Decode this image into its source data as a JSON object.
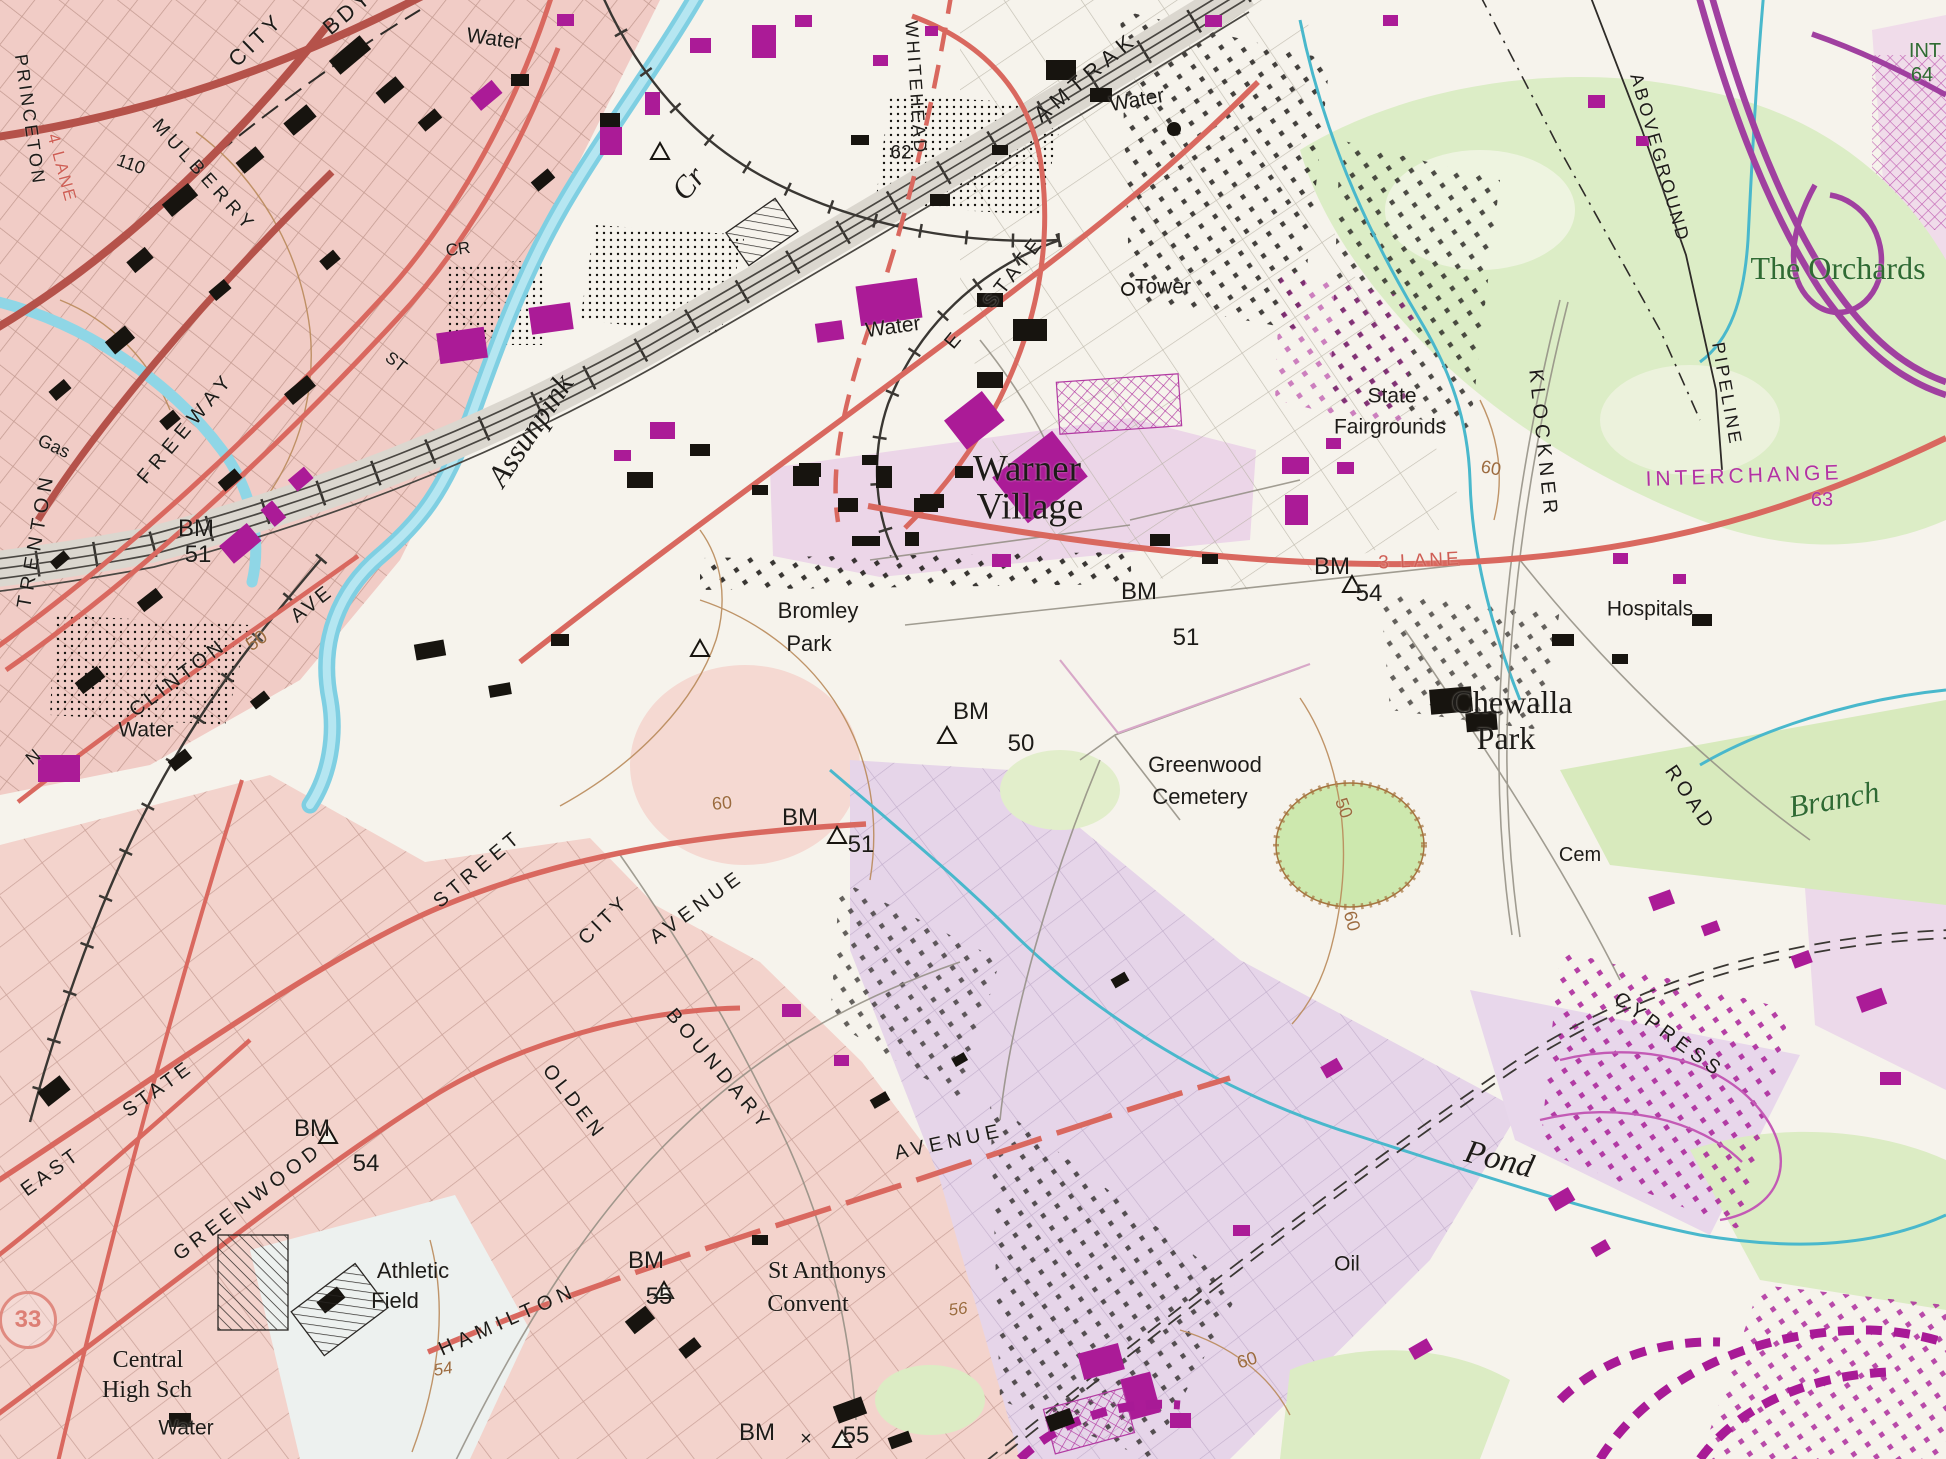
{
  "map": {
    "type": "scanned-topographic-map",
    "shield": {
      "text": "33"
    },
    "colors": {
      "paper": "#f6f3ec",
      "urban_pink": "#f1cdc7",
      "residential_lavender": "#e9d6ea",
      "park_green": "#d9ecc1",
      "water_cyan": "#a6dfee",
      "stream_teal": "#49b8cc",
      "road_red": "#d9685f",
      "building_magenta": "#ab1b97",
      "contour_brown": "#9c6b3f",
      "label_green": "#2f6b33",
      "highway_purple": "#a040a0",
      "ink_black": "#1d1b18"
    },
    "labels": [
      {
        "n": "water-top",
        "t": "Water",
        "x": 494,
        "y": 39,
        "r": 8,
        "s": 21
      },
      {
        "n": "city-bdy-1",
        "t": "CITY",
        "x": 256,
        "y": 40,
        "r": -44,
        "s": 22,
        "ls": 4
      },
      {
        "n": "city-bdy-2",
        "t": "BDY",
        "x": 348,
        "y": 12,
        "r": -40,
        "s": 22,
        "ls": 4
      },
      {
        "n": "princeton",
        "t": "PRINCETON",
        "x": 30,
        "y": 120,
        "r": 82,
        "s": 18,
        "ls": 3
      },
      {
        "n": "four-lane",
        "t": "4 LANE",
        "x": 62,
        "y": 168,
        "r": 75,
        "s": 17,
        "ls": 2,
        "c": "r"
      },
      {
        "n": "contour-110",
        "t": "110",
        "x": 131,
        "y": 164,
        "r": 20,
        "s": 18
      },
      {
        "n": "mulberry",
        "t": "MULBERRY",
        "x": 204,
        "y": 176,
        "r": 48,
        "s": 19,
        "ls": 5
      },
      {
        "n": "cr-abbrev",
        "t": "CR",
        "x": 458,
        "y": 249,
        "r": -8,
        "s": 17
      },
      {
        "n": "st-abbrev",
        "t": "ST",
        "x": 396,
        "y": 362,
        "r": 38,
        "s": 17
      },
      {
        "n": "assunpink",
        "t": "Assunpink",
        "x": 530,
        "y": 430,
        "r": -56,
        "s": 31,
        "f": "serif",
        "i": 1
      },
      {
        "n": "assunpink-cr",
        "t": "Cr",
        "x": 688,
        "y": 183,
        "r": -50,
        "s": 31,
        "f": "serif",
        "i": 1
      },
      {
        "n": "trenton",
        "t": "TRENTON",
        "x": 36,
        "y": 540,
        "r": -80,
        "s": 20,
        "ls": 6
      },
      {
        "n": "freeway",
        "t": "FREEWAY",
        "x": 186,
        "y": 428,
        "r": -50,
        "s": 20,
        "ls": 6
      },
      {
        "n": "gas",
        "t": "Gas",
        "x": 54,
        "y": 446,
        "r": 25,
        "s": 18
      },
      {
        "n": "bm-left",
        "t": "BM",
        "x": 196,
        "y": 529,
        "s": 24
      },
      {
        "n": "bm-left-51",
        "t": "51",
        "x": 198,
        "y": 555,
        "s": 24
      },
      {
        "n": "clinton",
        "t": "CLINTON",
        "x": 178,
        "y": 678,
        "r": -37,
        "s": 20,
        "ls": 4
      },
      {
        "n": "contour-50-clinton",
        "t": "50",
        "x": 257,
        "y": 641,
        "r": -35,
        "s": 19,
        "c": "b"
      },
      {
        "n": "clinton-ave",
        "t": "AVE",
        "x": 312,
        "y": 604,
        "r": -38,
        "s": 20,
        "ls": 3
      },
      {
        "n": "water-left",
        "t": "Water",
        "x": 146,
        "y": 730,
        "s": 21
      },
      {
        "n": "n-clinton",
        "t": "N",
        "x": 33,
        "y": 757,
        "r": -40,
        "s": 18
      },
      {
        "n": "whitehead",
        "t": "WHITEHEAD",
        "x": 916,
        "y": 88,
        "r": 86,
        "s": 18,
        "ls": 3
      },
      {
        "n": "amtrak",
        "t": "AMTRAK",
        "x": 1086,
        "y": 77,
        "r": -40,
        "s": 22,
        "ls": 6
      },
      {
        "n": "water-amtrak",
        "t": "Water",
        "x": 1137,
        "y": 100,
        "r": -10,
        "s": 21
      },
      {
        "n": "contour-62",
        "t": "62",
        "x": 901,
        "y": 153,
        "s": 19
      },
      {
        "n": "e-state-e",
        "t": "E",
        "x": 953,
        "y": 341,
        "r": -50,
        "s": 20
      },
      {
        "n": "e-state",
        "t": "STATE",
        "x": 1014,
        "y": 272,
        "r": -52,
        "s": 20,
        "ls": 5
      },
      {
        "n": "tower",
        "t": "Tower",
        "x": 1163,
        "y": 287,
        "s": 21
      },
      {
        "n": "state-fairgrounds-1",
        "t": "State",
        "x": 1392,
        "y": 396,
        "s": 21
      },
      {
        "n": "state-fairgrounds-2",
        "t": "Fairgrounds",
        "x": 1390,
        "y": 427,
        "s": 21
      },
      {
        "n": "warner-village-1",
        "t": "Warner",
        "x": 1027,
        "y": 469,
        "s": 37,
        "f": "serif"
      },
      {
        "n": "warner-village-2",
        "t": "Village",
        "x": 1030,
        "y": 507,
        "s": 37,
        "f": "serif"
      },
      {
        "n": "bromley-park-1",
        "t": "Bromley",
        "x": 818,
        "y": 611,
        "s": 22
      },
      {
        "n": "bromley-park-2",
        "t": "Park",
        "x": 809,
        "y": 644,
        "s": 22
      },
      {
        "n": "bm-warner",
        "t": "BM",
        "x": 1139,
        "y": 592,
        "s": 24
      },
      {
        "n": "bm-warner-51",
        "t": "51",
        "x": 1186,
        "y": 638,
        "s": 24
      },
      {
        "n": "bm-54",
        "t": "BM",
        "x": 1332,
        "y": 567,
        "s": 24
      },
      {
        "n": "bm-54-num",
        "t": "54",
        "x": 1369,
        "y": 594,
        "s": 24
      },
      {
        "n": "three-lane",
        "t": "3 LANE",
        "x": 1420,
        "y": 561,
        "r": -3,
        "s": 19,
        "ls": 3,
        "c": "r"
      },
      {
        "n": "klockner",
        "t": "KLOCKNER",
        "x": 1543,
        "y": 444,
        "r": 84,
        "s": 20,
        "ls": 5
      },
      {
        "n": "aboveground",
        "t": "ABOVEGROUND",
        "x": 1660,
        "y": 158,
        "r": 74,
        "s": 18,
        "ls": 3
      },
      {
        "n": "pipeline",
        "t": "PIPELINE",
        "x": 1727,
        "y": 394,
        "r": 80,
        "s": 18,
        "ls": 3
      },
      {
        "n": "interchange",
        "t": "INTERCHANGE",
        "x": 1744,
        "y": 476,
        "r": -2,
        "s": 21,
        "ls": 4,
        "c": "m"
      },
      {
        "n": "interchange-63",
        "t": "63",
        "x": 1822,
        "y": 500,
        "s": 20,
        "c": "m"
      },
      {
        "n": "contour-60-klockner",
        "t": "60",
        "x": 1491,
        "y": 468,
        "r": 10,
        "s": 18,
        "c": "b"
      },
      {
        "n": "the-orchards",
        "t": "The Orchards",
        "x": 1838,
        "y": 268,
        "s": 32,
        "f": "serif",
        "c": "g"
      },
      {
        "n": "int-64-1",
        "t": "INT",
        "x": 1925,
        "y": 51,
        "s": 20,
        "c": "g"
      },
      {
        "n": "int-64-2",
        "t": "64",
        "x": 1922,
        "y": 75,
        "s": 20,
        "c": "g"
      },
      {
        "n": "hospitals",
        "t": "Hospitals",
        "x": 1650,
        "y": 609,
        "s": 21
      },
      {
        "n": "chewalla-park-1",
        "t": "Chewalla",
        "x": 1512,
        "y": 702,
        "s": 32,
        "f": "serif"
      },
      {
        "n": "chewalla-park-2",
        "t": "Park",
        "x": 1506,
        "y": 738,
        "s": 32,
        "f": "serif"
      },
      {
        "n": "road",
        "t": "ROAD",
        "x": 1690,
        "y": 798,
        "r": 56,
        "s": 20,
        "ls": 4
      },
      {
        "n": "branch",
        "t": "Branch",
        "x": 1834,
        "y": 799,
        "r": -10,
        "s": 31,
        "f": "serif",
        "i": 1,
        "c": "g"
      },
      {
        "n": "greenwood-cemetery-1",
        "t": "Greenwood",
        "x": 1205,
        "y": 765,
        "s": 22
      },
      {
        "n": "greenwood-cemetery-2",
        "t": "Cemetery",
        "x": 1200,
        "y": 797,
        "s": 22
      },
      {
        "n": "cem",
        "t": "Cem",
        "x": 1580,
        "y": 855,
        "s": 20
      },
      {
        "n": "contour-50-cem",
        "t": "50",
        "x": 1344,
        "y": 808,
        "r": 70,
        "s": 18,
        "c": "b"
      },
      {
        "n": "contour-60-cem",
        "t": "60",
        "x": 1352,
        "y": 921,
        "r": 75,
        "s": 18,
        "c": "b"
      },
      {
        "n": "bm-50",
        "t": "BM",
        "x": 971,
        "y": 712,
        "s": 24
      },
      {
        "n": "bm-50-num",
        "t": "50",
        "x": 1021,
        "y": 744,
        "s": 24
      },
      {
        "n": "contour-60-center",
        "t": "60",
        "x": 722,
        "y": 803,
        "r": -5,
        "s": 18,
        "c": "b"
      },
      {
        "n": "bm-51-center",
        "t": "BM",
        "x": 800,
        "y": 818,
        "s": 24
      },
      {
        "n": "bm-51-center-num",
        "t": "51",
        "x": 861,
        "y": 845,
        "s": 24
      },
      {
        "n": "street",
        "t": "STREET",
        "x": 478,
        "y": 869,
        "r": -40,
        "s": 20,
        "ls": 5
      },
      {
        "n": "city-avenue-1",
        "t": "CITY",
        "x": 604,
        "y": 920,
        "r": -44,
        "s": 20,
        "ls": 4
      },
      {
        "n": "city-avenue-2",
        "t": "AVENUE",
        "x": 697,
        "y": 907,
        "r": -36,
        "s": 20,
        "ls": 5
      },
      {
        "n": "boundary",
        "t": "BOUNDARY",
        "x": 719,
        "y": 1070,
        "r": 50,
        "s": 20,
        "ls": 5
      },
      {
        "n": "olden",
        "t": "OLDEN",
        "x": 574,
        "y": 1102,
        "r": 52,
        "s": 20,
        "ls": 4
      },
      {
        "n": "hamilton-avenue",
        "t": "AVENUE",
        "x": 949,
        "y": 1142,
        "r": -12,
        "s": 20,
        "ls": 5
      },
      {
        "n": "cypress",
        "t": "CYPRESS",
        "x": 1669,
        "y": 1035,
        "r": 36,
        "s": 20,
        "ls": 5
      },
      {
        "n": "pond",
        "t": "Pond",
        "x": 1499,
        "y": 1160,
        "r": 14,
        "s": 33,
        "f": "serif",
        "i": 1
      },
      {
        "n": "oil",
        "t": "Oil",
        "x": 1347,
        "y": 1264,
        "s": 21
      },
      {
        "n": "east-state-1",
        "t": "EAST",
        "x": 51,
        "y": 1172,
        "r": -36,
        "s": 20,
        "ls": 4
      },
      {
        "n": "east-state-2",
        "t": "STATE",
        "x": 158,
        "y": 1089,
        "r": -36,
        "s": 20,
        "ls": 4
      },
      {
        "n": "greenwood-ave",
        "t": "GREENWOOD",
        "x": 248,
        "y": 1202,
        "r": -37,
        "s": 20,
        "ls": 5
      },
      {
        "n": "bm-54-bottom",
        "t": "BM",
        "x": 312,
        "y": 1129,
        "s": 24
      },
      {
        "n": "bm-54-bottom-num",
        "t": "54",
        "x": 366,
        "y": 1164,
        "s": 24
      },
      {
        "n": "central-high-1",
        "t": "Central",
        "x": 148,
        "y": 1360,
        "s": 24,
        "f": "serif"
      },
      {
        "n": "central-high-2",
        "t": "High Sch",
        "x": 147,
        "y": 1390,
        "s": 24,
        "f": "serif"
      },
      {
        "n": "water-bottom",
        "t": "Water",
        "x": 186,
        "y": 1428,
        "s": 21
      },
      {
        "n": "athletic-field-1",
        "t": "Athletic",
        "x": 413,
        "y": 1271,
        "s": 22
      },
      {
        "n": "athletic-field-2",
        "t": "Field",
        "x": 395,
        "y": 1301,
        "s": 22
      },
      {
        "n": "hamilton",
        "t": "HAMILTON",
        "x": 508,
        "y": 1320,
        "r": -24,
        "s": 20,
        "ls": 6
      },
      {
        "n": "contour-54-italic",
        "t": "54",
        "x": 443,
        "y": 1369,
        "r": -10,
        "s": 17,
        "i": 1,
        "c": "b"
      },
      {
        "n": "bm-55",
        "t": "BM",
        "x": 646,
        "y": 1261,
        "s": 24
      },
      {
        "n": "bm-55-num",
        "t": "55",
        "x": 659,
        "y": 1297,
        "s": 24
      },
      {
        "n": "st-anthonys-1",
        "t": "St Anthonys",
        "x": 827,
        "y": 1271,
        "s": 24,
        "f": "serif"
      },
      {
        "n": "st-anthonys-2",
        "t": "Convent",
        "x": 808,
        "y": 1304,
        "s": 24,
        "f": "serif"
      },
      {
        "n": "contour-56-italic",
        "t": "56",
        "x": 958,
        "y": 1309,
        "r": -8,
        "s": 17,
        "i": 1,
        "c": "b"
      },
      {
        "n": "bm-55-bottom",
        "t": "BM",
        "x": 757,
        "y": 1433,
        "s": 24
      },
      {
        "n": "bm-55-bottom-x",
        "t": "×",
        "x": 806,
        "y": 1439,
        "s": 20
      },
      {
        "n": "bm-55-bottom-num",
        "t": "55",
        "x": 856,
        "y": 1436,
        "s": 24
      },
      {
        "n": "contour-60-bottom",
        "t": "60",
        "x": 1247,
        "y": 1360,
        "r": -18,
        "s": 18,
        "c": "b"
      },
      {
        "n": "water-estate",
        "t": "Water",
        "x": 893,
        "y": 327,
        "r": -8,
        "s": 21
      }
    ]
  }
}
